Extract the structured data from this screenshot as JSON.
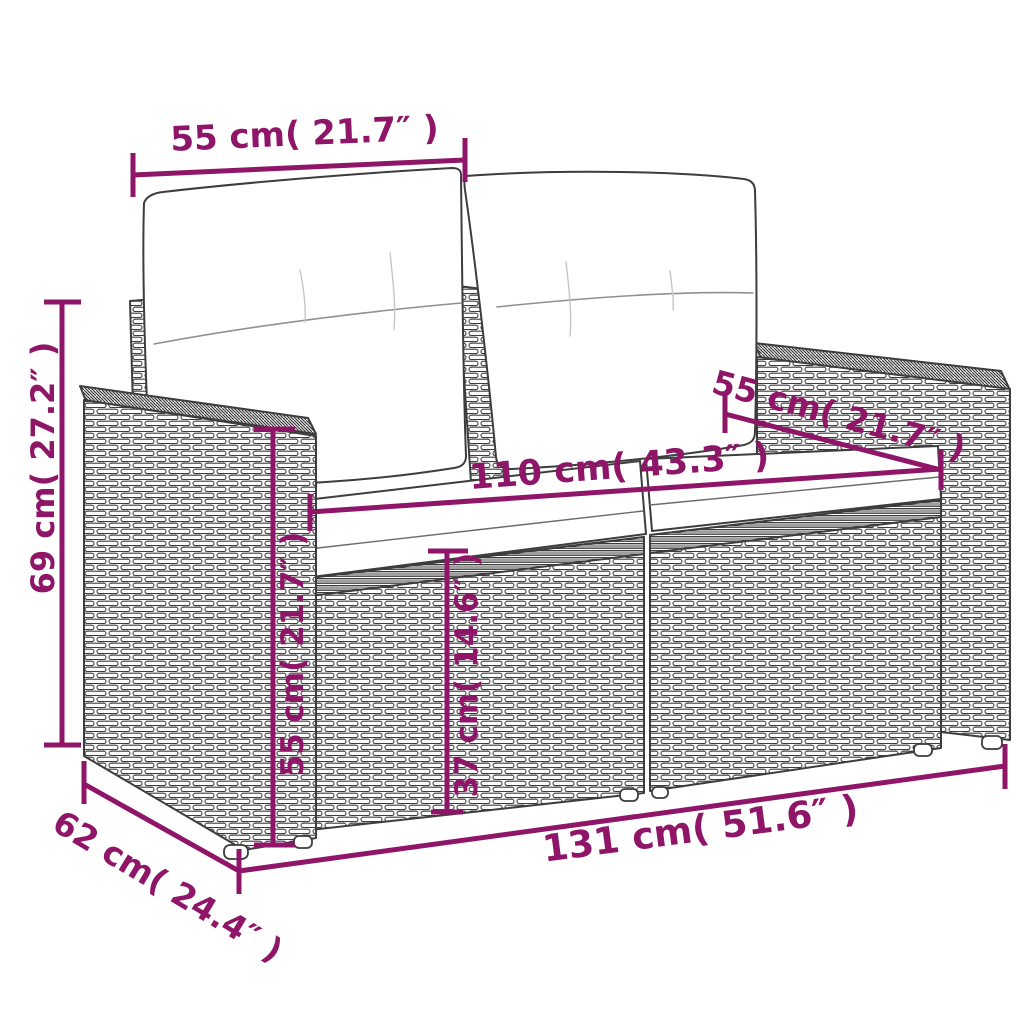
{
  "colors": {
    "dimension_annotation": "#8e1568",
    "artwork_line": "#3d3d3d"
  },
  "dimensions": {
    "backrest_width": {
      "label": "55 cm( 21.7″ )",
      "placement": "top"
    },
    "overall_height": {
      "label": "69 cm( 27.2″ )",
      "placement": "left"
    },
    "armrest_depth": {
      "label": "55 cm( 21.7″ )",
      "placement": "upper-right"
    },
    "seat_width": {
      "label": "110 cm( 43.3″ )",
      "placement": "center"
    },
    "armrest_height": {
      "label": "55 cm( 21.7″ )",
      "placement": "inner-left"
    },
    "seat_height": {
      "label": "37 cm( 14.6″ )",
      "placement": "center-vertical"
    },
    "overall_depth": {
      "label": "62 cm( 24.4″ )",
      "placement": "bottom-left"
    },
    "overall_width": {
      "label": "131 cm( 51.6″ )",
      "placement": "bottom"
    }
  }
}
